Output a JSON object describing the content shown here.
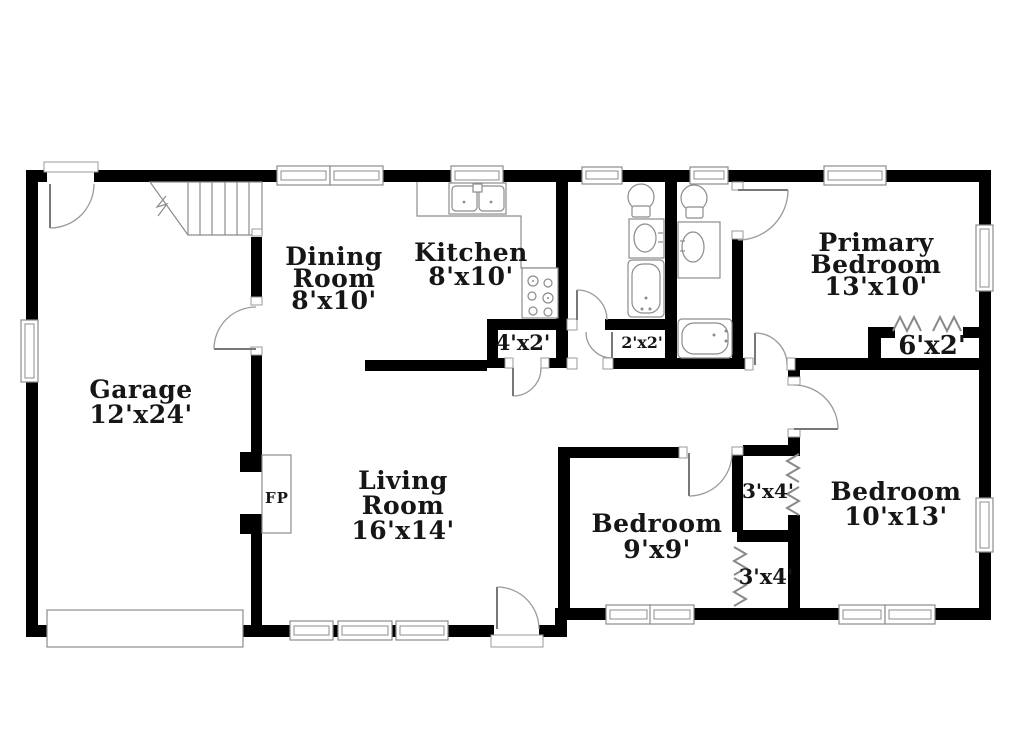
{
  "plan": {
    "rooms": {
      "garage": {
        "line1": "Garage",
        "line2": "12'x24'"
      },
      "dining_room": {
        "line1": "Dining",
        "line2": "Room",
        "line3": "8'x10'"
      },
      "kitchen": {
        "line1": "Kitchen",
        "line2": "8'x10'"
      },
      "primary_bedroom": {
        "line1": "Primary",
        "line2": "Bedroom",
        "line3": "13'x10'"
      },
      "living_room": {
        "line1": "Living",
        "line2": "Room",
        "line3": "16'x14'"
      },
      "bedroom_9x9": {
        "line1": "Bedroom",
        "line2": "9'x9'"
      },
      "bedroom_10x13": {
        "line1": "Bedroom",
        "line2": "10'x13'"
      }
    },
    "closets": {
      "hall_closet": "4'x2'",
      "linen_closet": "2'x2'",
      "primary_closet": "6'x2'",
      "closet_upper": "3'x4'",
      "closet_lower": "3'x4'"
    },
    "fireplace": "FP",
    "colors": {
      "wall": "#000000",
      "line": "#8c8c8c",
      "background": "#ffffff",
      "text": "#161616"
    }
  }
}
